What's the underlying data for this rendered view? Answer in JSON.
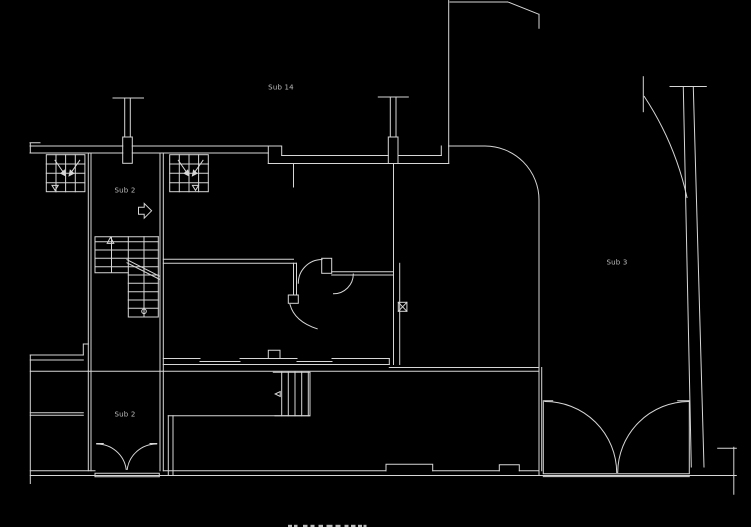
{
  "canvas": {
    "width": 751,
    "height": 527,
    "background": "#000000",
    "line_color": "#d6d6d6",
    "label_color": "#bdbdbd"
  },
  "labels": {
    "unit_top": "Sub 14",
    "stair_hall": "Sub 2",
    "unit_right": "Sub 3",
    "lower_room": "Sub 2"
  }
}
